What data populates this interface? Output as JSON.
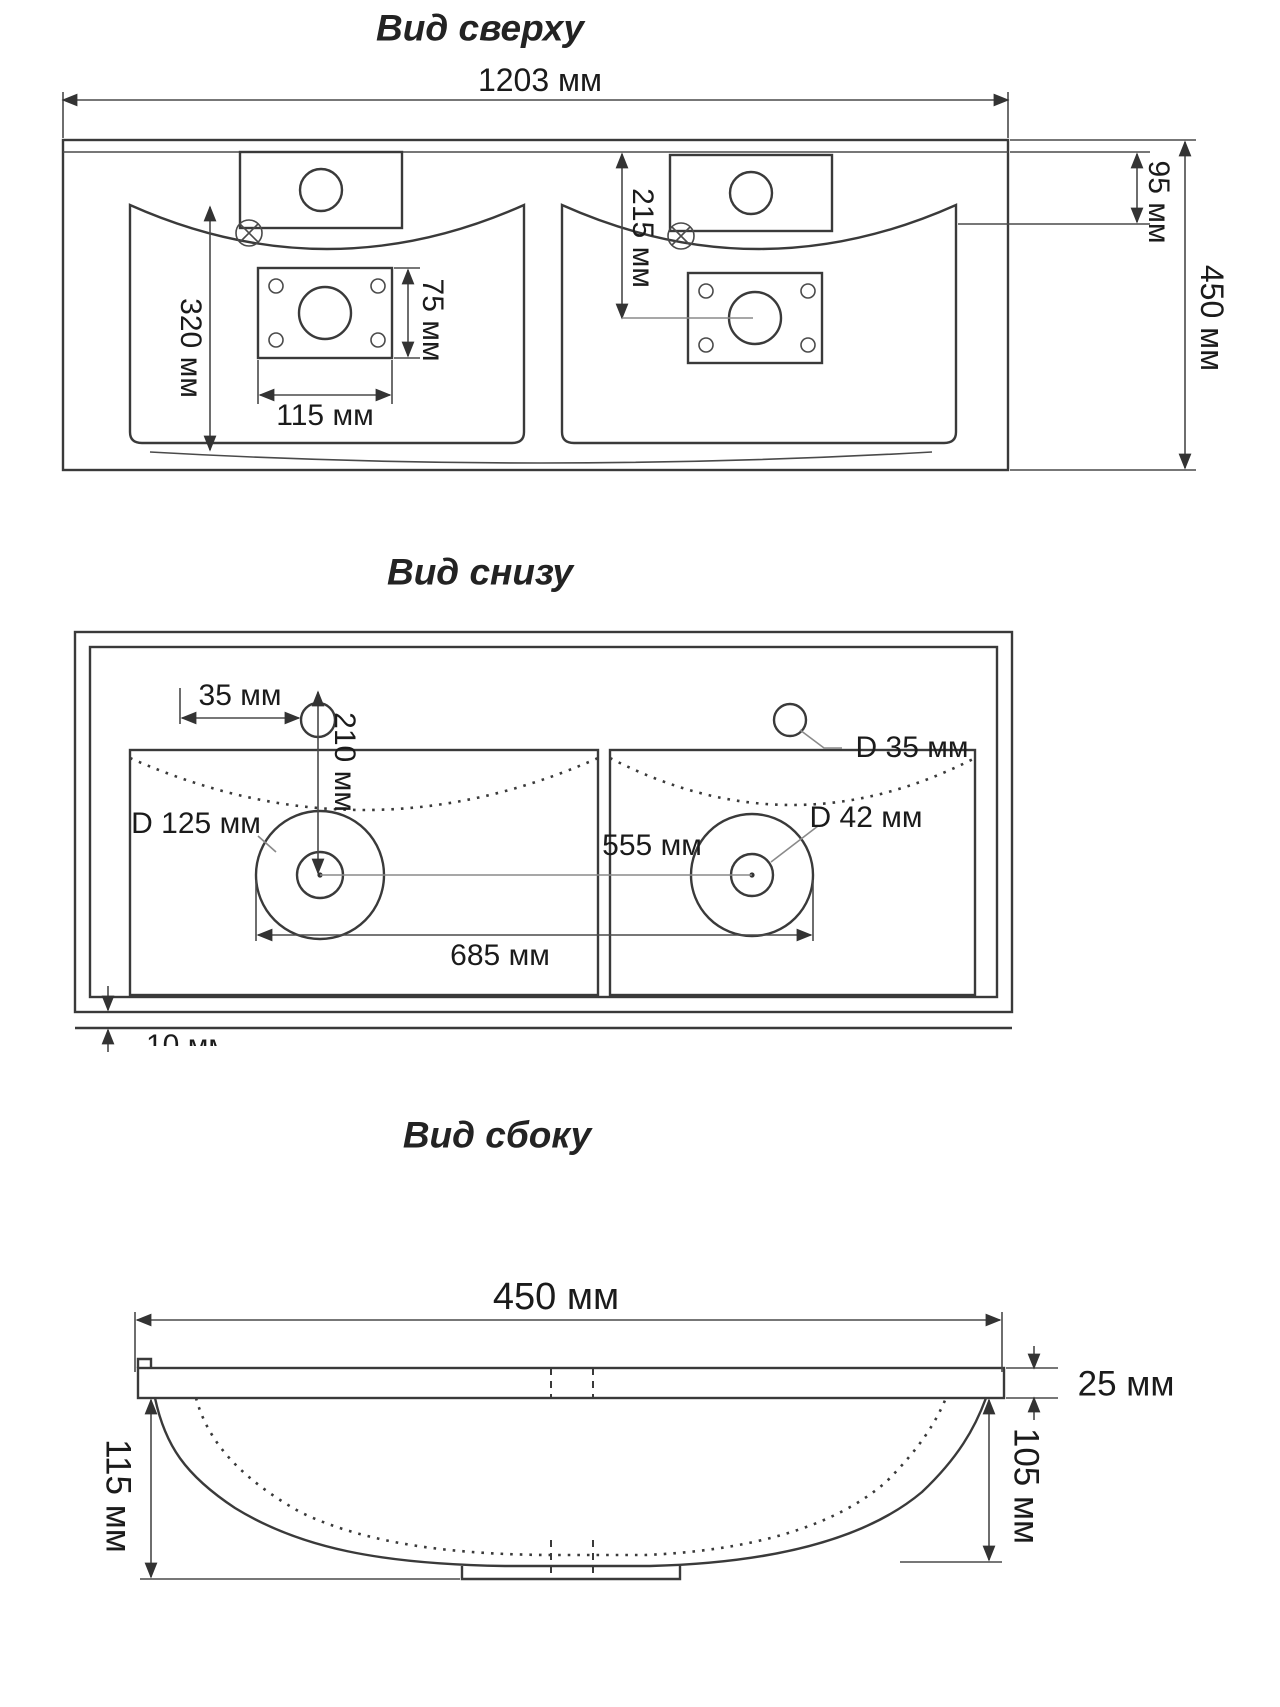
{
  "drawing": {
    "unit": "мм",
    "views": {
      "top": {
        "title": "Вид сверху",
        "dims": {
          "overall_width": "1203 мм",
          "overall_depth": "450 мм",
          "back_to_basin": "95 мм",
          "drain_from_back": "215 мм",
          "basin_length": "320 мм",
          "plate_width": "115 мм",
          "plate_height": "75 мм"
        }
      },
      "bottom": {
        "title": "Вид снизу",
        "dims": {
          "faucet_offset": "35 мм",
          "faucet_to_drain": "210 мм",
          "faucet_hole_diameter": "D 35 мм",
          "recess_diameter": "D 125 мм",
          "drain_spacing": "555 мм",
          "drain_hole_diameter": "D 42 мм",
          "recess_outer_span": "685 мм",
          "edge_thickness_clipped": "10 мм"
        }
      },
      "side": {
        "title": "Вид сбоку",
        "dims": {
          "depth": "450 мм",
          "rim_thickness": "25 мм",
          "bowl_depth": "105 мм",
          "overall_height": "115 мм"
        }
      }
    }
  }
}
